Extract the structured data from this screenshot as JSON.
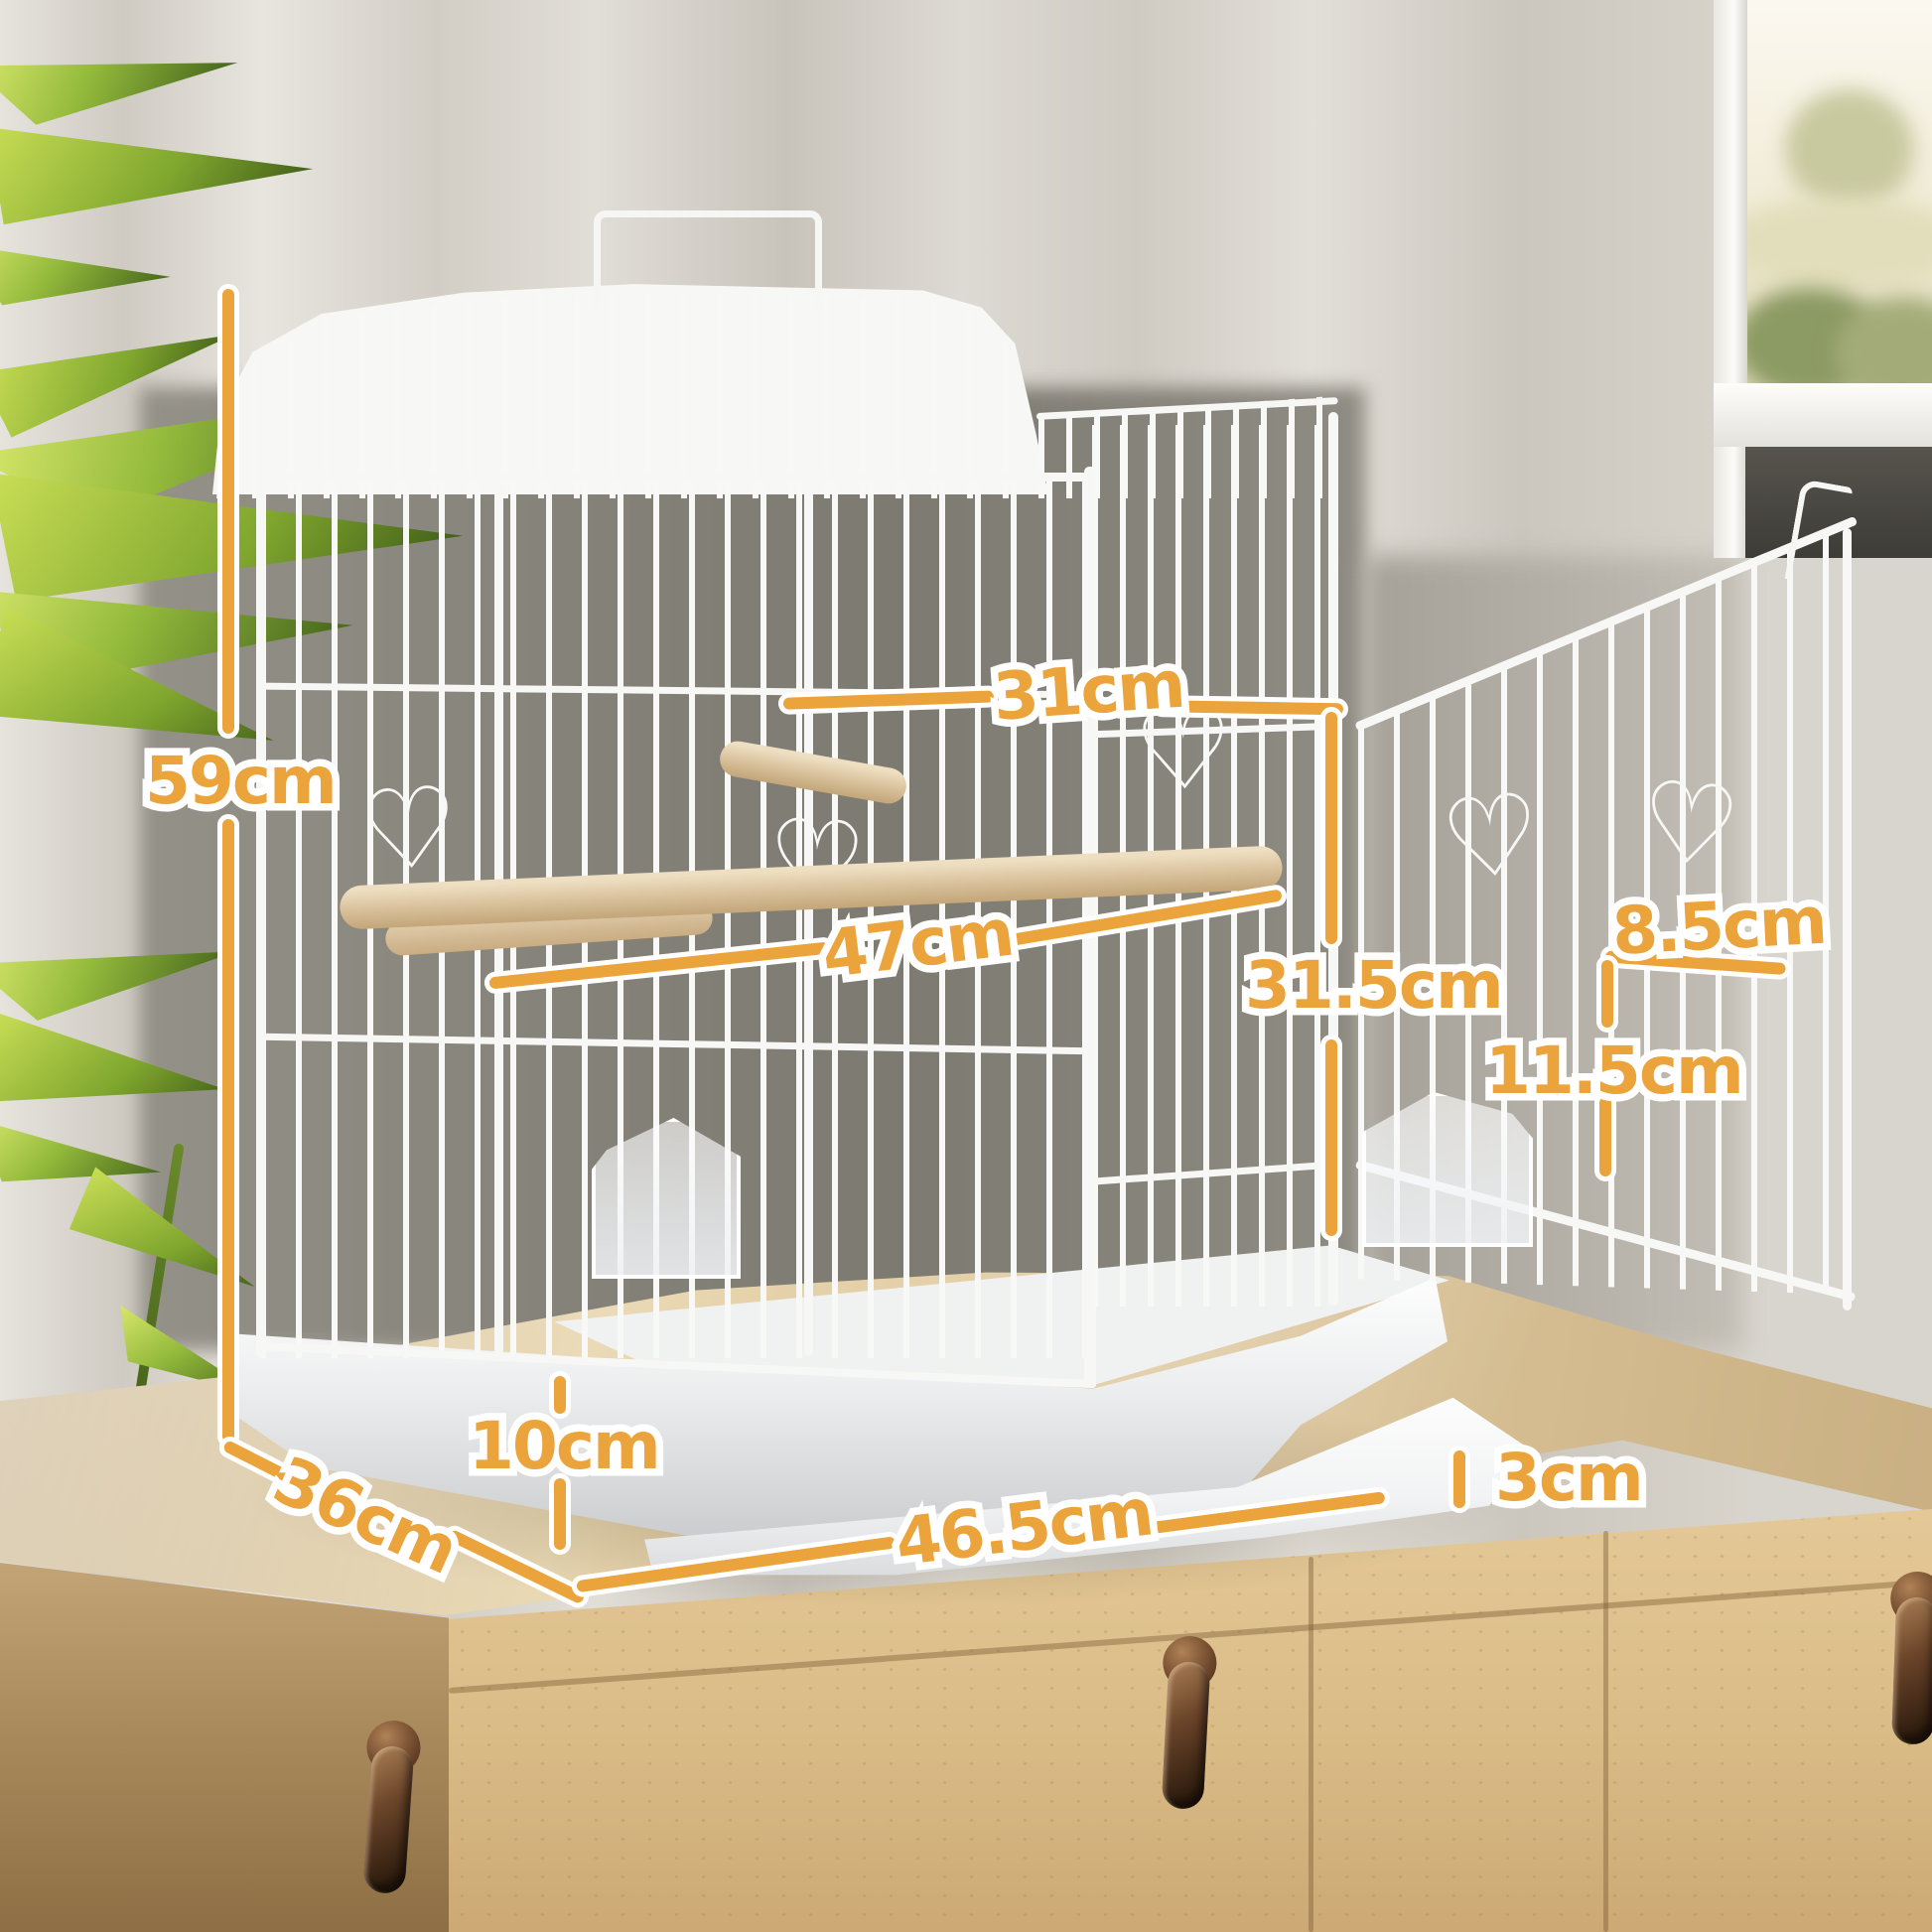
{
  "meta": {
    "image_type": "product dimension diagram",
    "product": "white wire bird cage with open side door, on wooden sideboard"
  },
  "palette": {
    "accent_orange": "#EBA33C",
    "outline_white": "#FFFFFF",
    "cage_white": "#F7F7F5",
    "wood_light": "#E4C897",
    "wood_dark": "#8E6F45",
    "leaf_green": "#94BA3C",
    "wall_gray": "#85827A",
    "curtain_gray": "#D8D5CE",
    "handle_bronze": "#6B452A"
  },
  "decor": {
    "heart_glyph": "♡"
  },
  "annotations": [
    {
      "id": "overall-height",
      "label": "59cm",
      "value": 59,
      "unit": "cm",
      "orientation": "vertical"
    },
    {
      "id": "top-width",
      "label": "31cm",
      "value": 31,
      "unit": "cm",
      "orientation": "horizontal"
    },
    {
      "id": "perch-width",
      "label": "47cm",
      "value": 47,
      "unit": "cm",
      "orientation": "horizontal"
    },
    {
      "id": "side-height",
      "label": "31.5cm",
      "value": 31.5,
      "unit": "cm",
      "orientation": "vertical"
    },
    {
      "id": "door-opening-width",
      "label": "8.5cm",
      "value": 8.5,
      "unit": "cm",
      "orientation": "horizontal"
    },
    {
      "id": "door-opening-height",
      "label": "11.5cm",
      "value": 11.5,
      "unit": "cm",
      "orientation": "vertical"
    },
    {
      "id": "base-height",
      "label": "10cm",
      "value": 10,
      "unit": "cm",
      "orientation": "vertical"
    },
    {
      "id": "depth",
      "label": "36cm",
      "value": 36,
      "unit": "cm",
      "orientation": "diagonal"
    },
    {
      "id": "tray-width",
      "label": "46.5cm",
      "value": 46.5,
      "unit": "cm",
      "orientation": "horizontal"
    },
    {
      "id": "tray-lip-height",
      "label": "3cm",
      "value": 3,
      "unit": "cm",
      "orientation": "vertical"
    }
  ]
}
